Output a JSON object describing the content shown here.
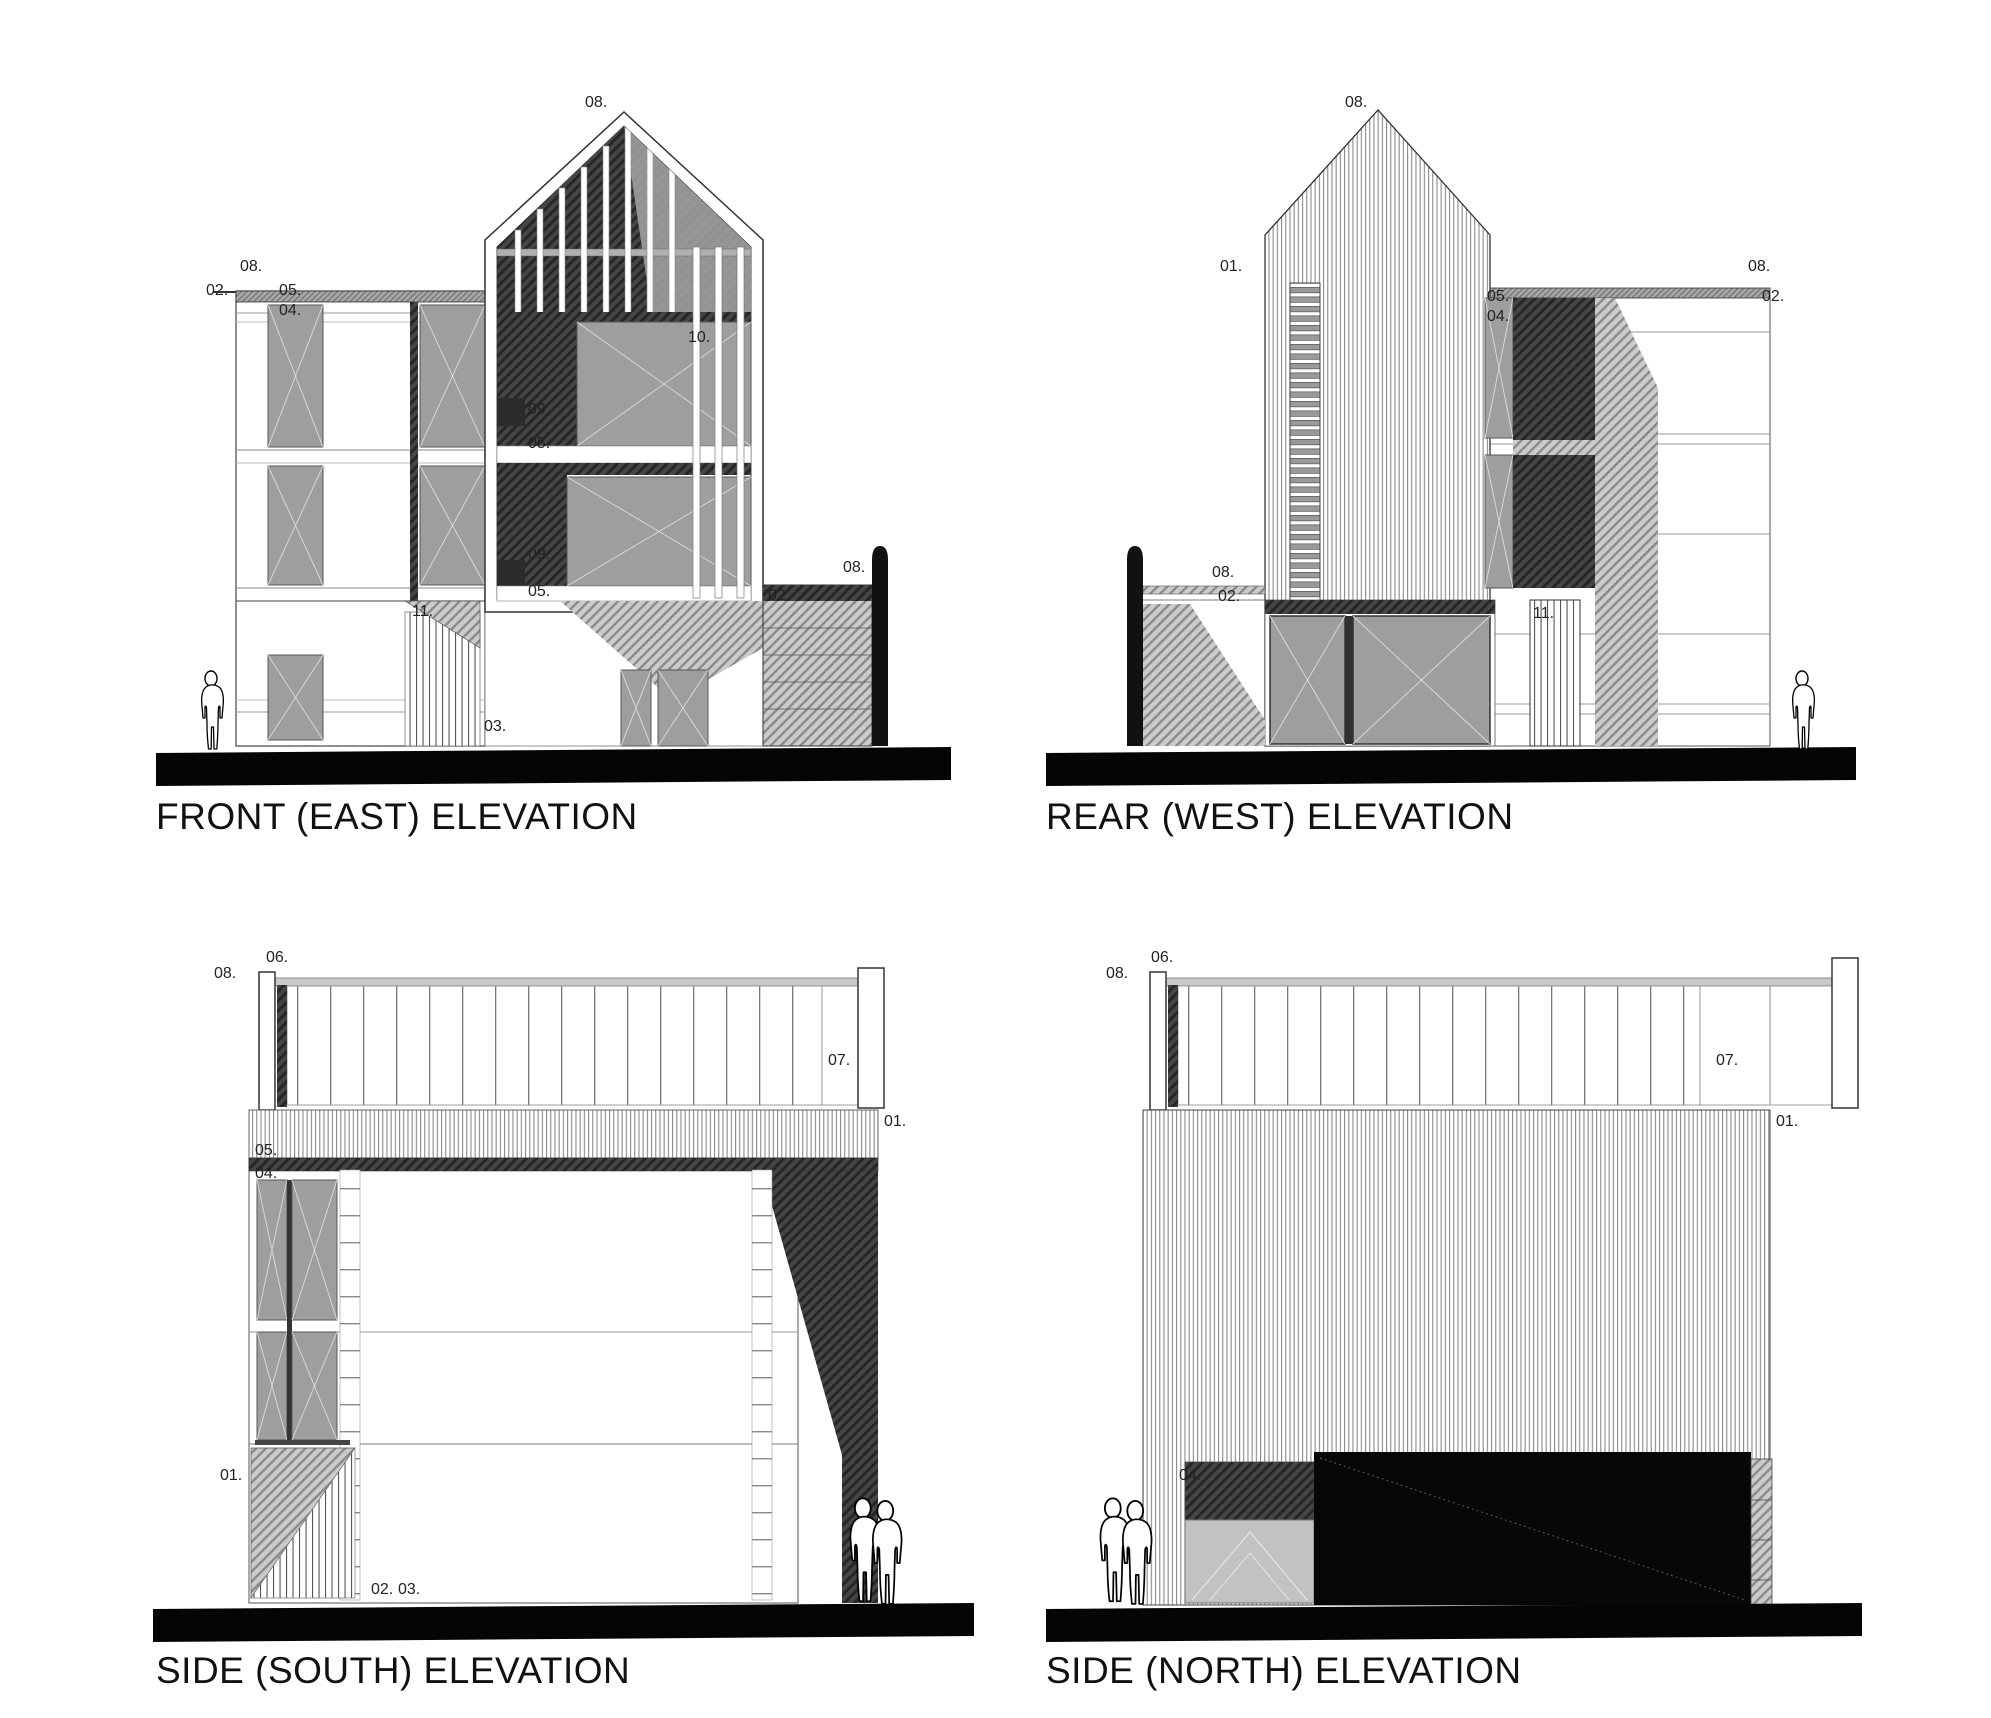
{
  "drawing": {
    "type": "architectural-elevation-sheet",
    "background": "#ffffff",
    "ink": "#1a1a1a",
    "panel_gray": "#9e9e9e",
    "hatch_dark": "#454545",
    "hatch_medium": "#8a8a8a",
    "ground_color": "#050505"
  },
  "elevations": [
    {
      "id": "front-east",
      "title": "FRONT (EAST) ELEVATION",
      "annotations": [
        {
          "t": "08.",
          "x": 585,
          "y": 95
        },
        {
          "t": "08.",
          "x": 240,
          "y": 259
        },
        {
          "t": "02.",
          "x": 206,
          "y": 283
        },
        {
          "t": "05.",
          "x": 279,
          "y": 283
        },
        {
          "t": "04.",
          "x": 279,
          "y": 303
        },
        {
          "t": "10.",
          "x": 688,
          "y": 330
        },
        {
          "t": "09.",
          "x": 528,
          "y": 402
        },
        {
          "t": "05.",
          "x": 528,
          "y": 436
        },
        {
          "t": "09.",
          "x": 528,
          "y": 547
        },
        {
          "t": "05.",
          "x": 528,
          "y": 584
        },
        {
          "t": "11.",
          "x": 412,
          "y": 604
        },
        {
          "t": "03.",
          "x": 484,
          "y": 719
        },
        {
          "t": "08.",
          "x": 843,
          "y": 560
        },
        {
          "t": "02.",
          "x": 768,
          "y": 588
        }
      ]
    },
    {
      "id": "rear-west",
      "title": "REAR (WEST) ELEVATION",
      "annotations": [
        {
          "t": "08.",
          "x": 1345,
          "y": 95
        },
        {
          "t": "01.",
          "x": 1220,
          "y": 259
        },
        {
          "t": "08.",
          "x": 1748,
          "y": 259
        },
        {
          "t": "02.",
          "x": 1762,
          "y": 289
        },
        {
          "t": "05.",
          "x": 1487,
          "y": 289
        },
        {
          "t": "04.",
          "x": 1487,
          "y": 309
        },
        {
          "t": "08.",
          "x": 1212,
          "y": 565
        },
        {
          "t": "02.",
          "x": 1218,
          "y": 589
        },
        {
          "t": "11.",
          "x": 1533,
          "y": 606
        }
      ]
    },
    {
      "id": "side-south",
      "title": "SIDE (SOUTH) ELEVATION",
      "annotations": [
        {
          "t": "06.",
          "x": 266,
          "y": 950
        },
        {
          "t": "08.",
          "x": 214,
          "y": 966
        },
        {
          "t": "07.",
          "x": 828,
          "y": 1053
        },
        {
          "t": "01.",
          "x": 884,
          "y": 1114
        },
        {
          "t": "05.",
          "x": 255,
          "y": 1143
        },
        {
          "t": "04.",
          "x": 255,
          "y": 1166
        },
        {
          "t": "01.",
          "x": 220,
          "y": 1468
        },
        {
          "t": "02.",
          "x": 371,
          "y": 1582
        },
        {
          "t": "03.",
          "x": 398,
          "y": 1582
        }
      ]
    },
    {
      "id": "side-north",
      "title": "SIDE (NORTH) ELEVATION",
      "annotations": [
        {
          "t": "06.",
          "x": 1151,
          "y": 950
        },
        {
          "t": "08.",
          "x": 1106,
          "y": 966
        },
        {
          "t": "07.",
          "x": 1716,
          "y": 1053
        },
        {
          "t": "01.",
          "x": 1776,
          "y": 1114
        },
        {
          "t": "04.",
          "x": 1179,
          "y": 1468
        }
      ]
    }
  ]
}
